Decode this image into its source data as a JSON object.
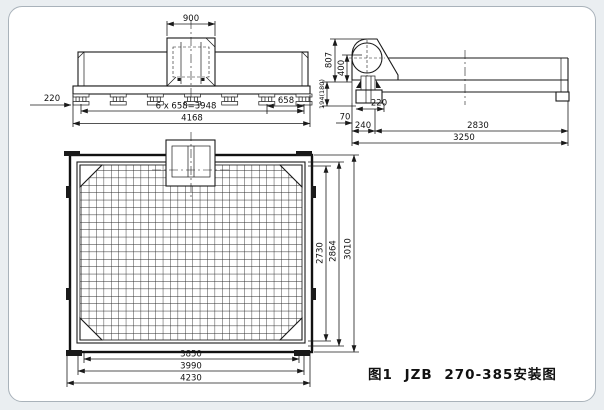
{
  "caption": "图1 JZB 270-385安装图",
  "colors": {
    "line": "#1a1a1a",
    "card_border": "#a9b2ba",
    "card_bg": "#ffffff",
    "page_bg": "#eaeef1"
  },
  "views": {
    "front": {
      "title": "front-elevation",
      "dims": {
        "seat_width": "900",
        "left_offset": "220",
        "foot_pitch": "6 x 658=3948",
        "end_pitch": "658",
        "total_length": "4168"
      }
    },
    "side": {
      "title": "side-elevation",
      "dims": {
        "total_height": "807",
        "exciter_height": "400",
        "base_height": "194(180)",
        "foot_width": "220",
        "edge_gap": "70",
        "foot_offset": "240",
        "support_span": "2830",
        "total_length": "3250"
      }
    },
    "plan": {
      "title": "plan-view",
      "dims": {
        "mesh_width": "2730",
        "frame_width": "2864",
        "total_width": "3010",
        "mesh_length": "3850",
        "frame_length": "3990",
        "total_length": "4230"
      }
    }
  }
}
